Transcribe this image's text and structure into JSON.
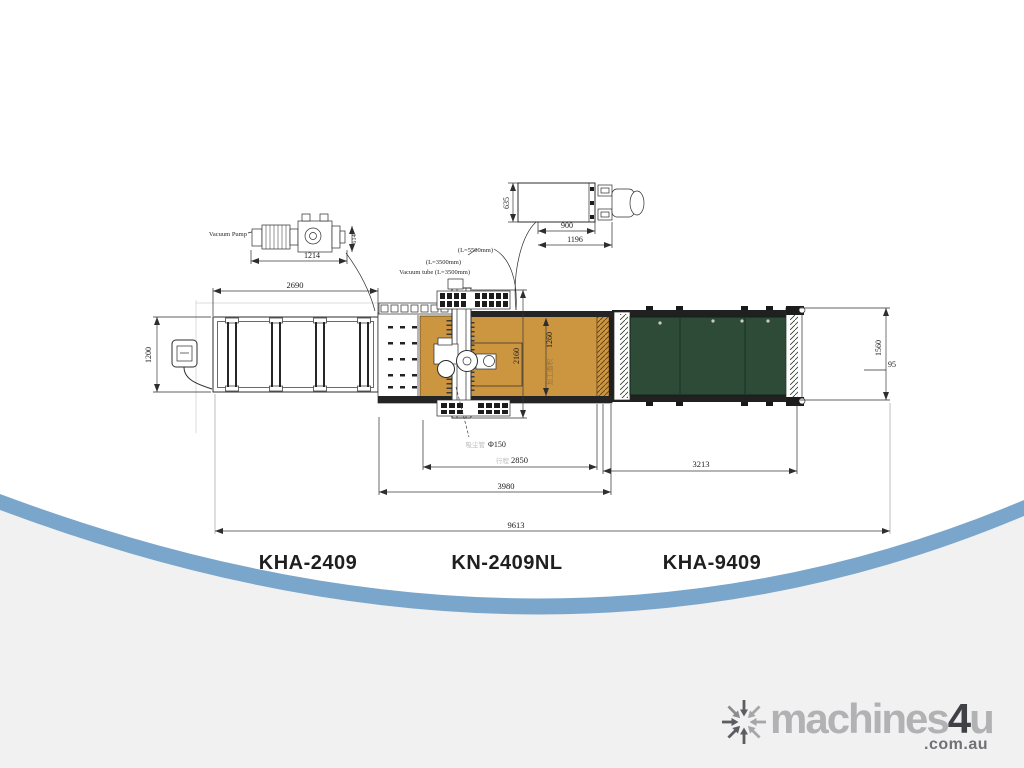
{
  "drawing": {
    "colors": {
      "table_orange": "#cc9540",
      "belt_green": "#2e4b38",
      "swoosh_blue": "#7ba6cb",
      "footer_gray": "#f1f1f2"
    },
    "labels": {
      "vacuum_pump": "Vacuum Pump",
      "tube_note_1": "(L=5500mm)",
      "tube_note_2": "(L=3500mm)",
      "tube_note_3": "Vacuum tube (L=3500mm)",
      "dust_port_cn": "吸尘管",
      "dust_port": "Φ150",
      "stroke_cn": "行程",
      "work_area_cn": "加工面积"
    },
    "dims": {
      "pump_length": "1214",
      "pump_width": "614",
      "panel_depth": "635",
      "panel_w1": "900",
      "panel_w2": "1196",
      "infeed_length": "2690",
      "infeed_width": "1200",
      "machine_width": "2160",
      "work_width": "1260",
      "x_travel": "2850",
      "machine_length": "3980",
      "outfeed_length": "3213",
      "outfeed_width": "1560",
      "offset": "95",
      "overall_length": "9613"
    }
  },
  "models": [
    {
      "label": "KHA-2409"
    },
    {
      "label": "KN-2409NL"
    },
    {
      "label": "KHA-9409"
    }
  ],
  "watermark": {
    "brand_prefix": "machines",
    "brand_four": "4",
    "brand_suffix": "u",
    "domain": ".com.au"
  }
}
